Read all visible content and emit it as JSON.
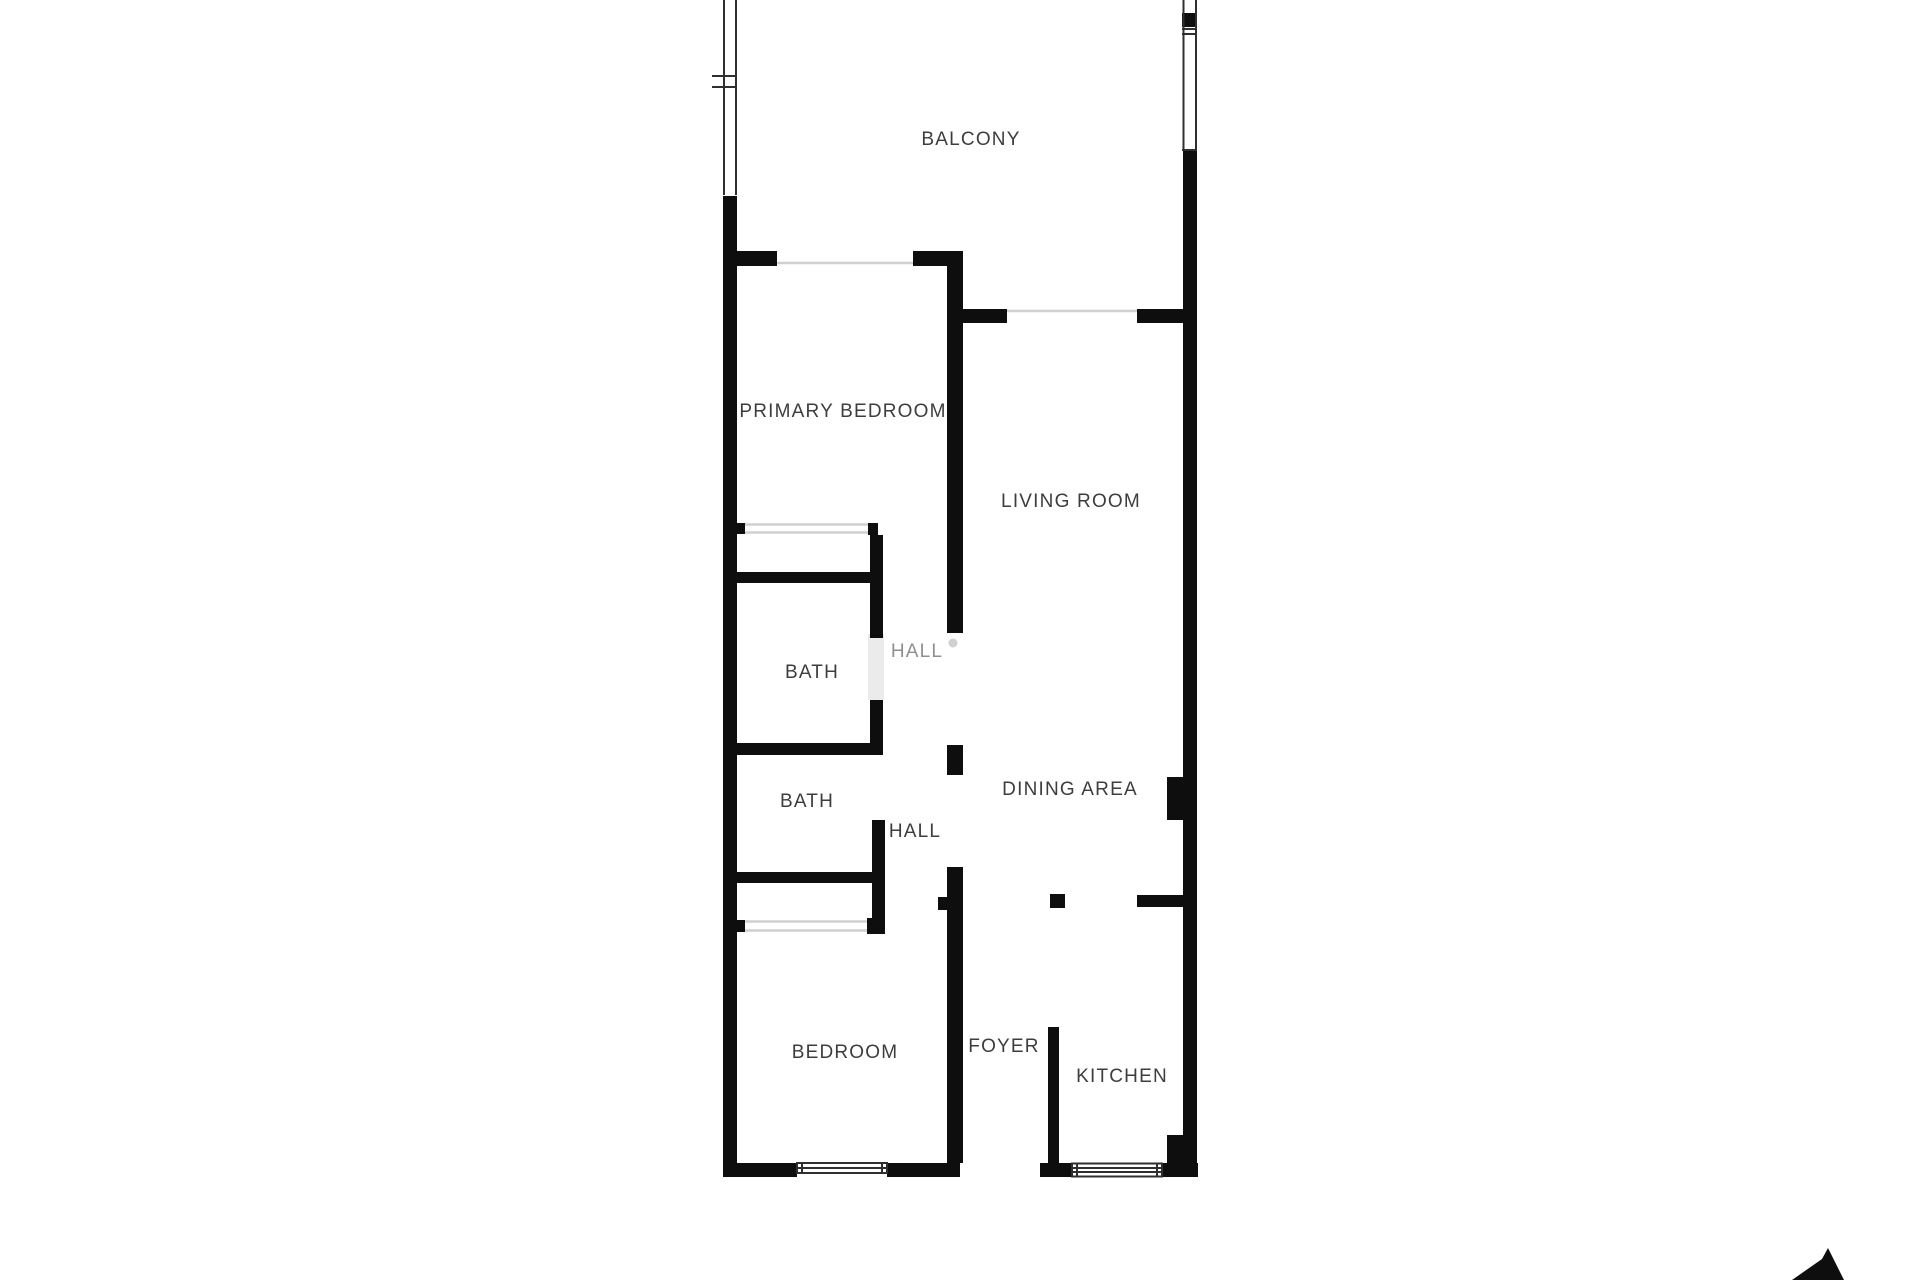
{
  "floor_plan": {
    "rooms": [
      {
        "id": "balcony",
        "label": "BALCONY"
      },
      {
        "id": "primary-bedroom",
        "label": "PRIMARY BEDROOM"
      },
      {
        "id": "living-room",
        "label": "LIVING ROOM"
      },
      {
        "id": "bath-1",
        "label": "BATH"
      },
      {
        "id": "hall-1",
        "label": "HALL"
      },
      {
        "id": "bath-2",
        "label": "BATH"
      },
      {
        "id": "hall-2",
        "label": "HALL"
      },
      {
        "id": "dining-area",
        "label": "DINING AREA"
      },
      {
        "id": "bedroom",
        "label": "BEDROOM"
      },
      {
        "id": "foyer",
        "label": "FOYER"
      },
      {
        "id": "kitchen",
        "label": "KITCHEN"
      }
    ],
    "colors": {
      "background": "#ffffff",
      "wall": "#0e0e0e",
      "label": "#3d3d3d",
      "label_faded": "#8f8f8f",
      "window_line": "#2f2f2f",
      "opening_line": "#d0d0d0",
      "compass": "#0e0e0e"
    }
  }
}
